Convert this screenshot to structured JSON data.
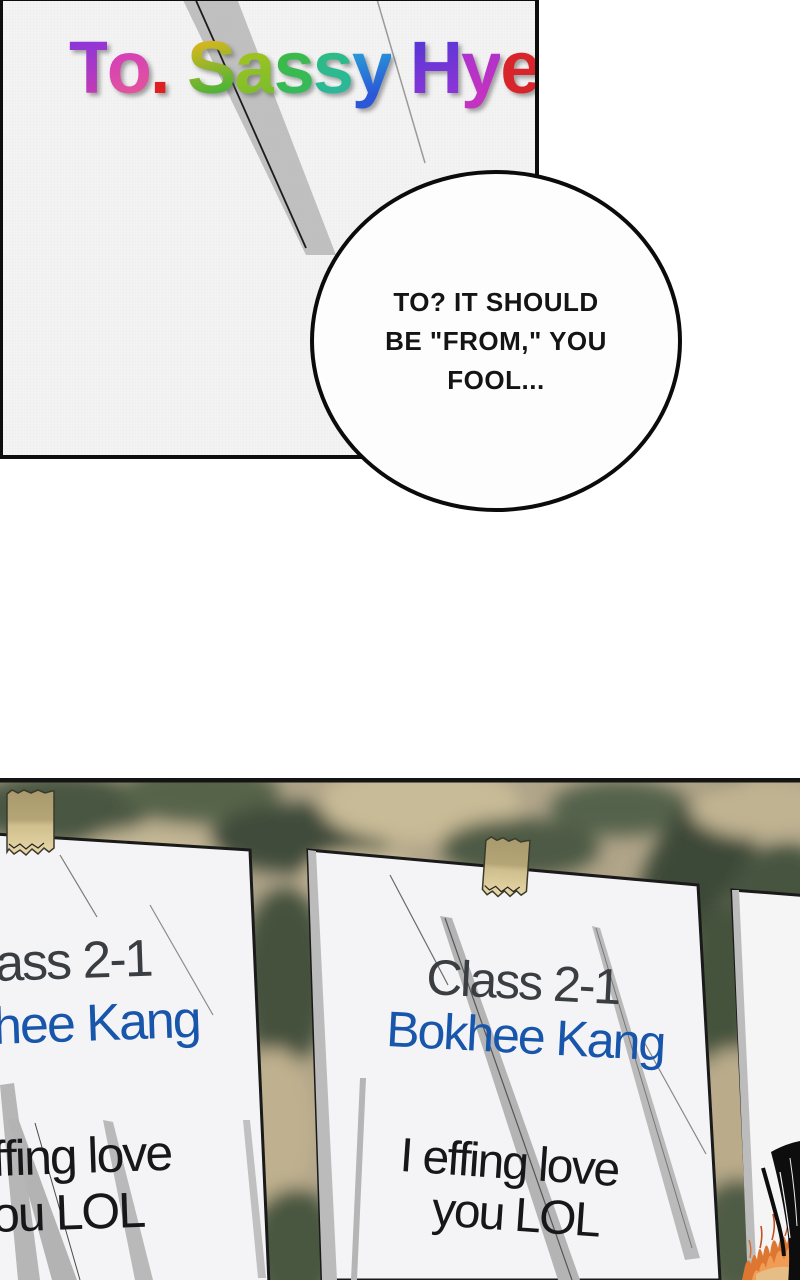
{
  "panel_letter": {
    "title_text": "To. Sassy Hyeok",
    "title_letters": [
      {
        "ch": "T",
        "c1": "#8d35d8",
        "c2": "#c33bb4"
      },
      {
        "ch": "o",
        "c1": "#d139c0",
        "c2": "#e2559c"
      },
      {
        "ch": ".",
        "c1": "#e02020",
        "c2": "#e02020"
      },
      {
        "ch": " ",
        "c1": "#000000",
        "c2": "#000000"
      },
      {
        "ch": "S",
        "c1": "#d9b61e",
        "c2": "#47b438"
      },
      {
        "ch": "a",
        "c1": "#a8c41e",
        "c2": "#7cbe2a"
      },
      {
        "ch": "s",
        "c1": "#3eb943",
        "c2": "#35ba5c"
      },
      {
        "ch": "s",
        "c1": "#2fbc7e",
        "c2": "#29b89b"
      },
      {
        "ch": "y",
        "c1": "#28a7d6",
        "c2": "#2b57d8"
      },
      {
        "ch": " ",
        "c1": "#000000",
        "c2": "#000000"
      },
      {
        "ch": "H",
        "c1": "#5936d6",
        "c2": "#8c35d6"
      },
      {
        "ch": "y",
        "c1": "#a833cf",
        "c2": "#c332c0"
      },
      {
        "ch": "e",
        "c1": "#d8252b",
        "c2": "#d8252b"
      },
      {
        "ch": "o",
        "c1": "#dc7a1c",
        "c2": "#d9a81e"
      },
      {
        "ch": "k",
        "c1": "#b3c41c",
        "c2": "#8fc321"
      }
    ]
  },
  "speech_bubble": {
    "lines": [
      "TO? IT SHOULD",
      "BE \"FROM,\" YOU",
      "FOOL..."
    ]
  },
  "board": {
    "papers": {
      "left": {
        "class_line": "ass 2-1",
        "name_line": "hee Kang",
        "message_line1": "ffing love",
        "message_line2": "ou LOL"
      },
      "middle": {
        "class_line": "Class 2-1",
        "name_line": "Bokhee Kang",
        "message_line1": "I effing love",
        "message_line2": "you LOL"
      }
    },
    "colors": {
      "name_blue": "#1856ac",
      "class_gray": "#3a3e42",
      "message_black": "#17171a",
      "tape": "#e0cf9e",
      "texture_dark": "#46523f",
      "texture_tan": "#b0a489",
      "flame_orange": "#dd7630"
    }
  }
}
